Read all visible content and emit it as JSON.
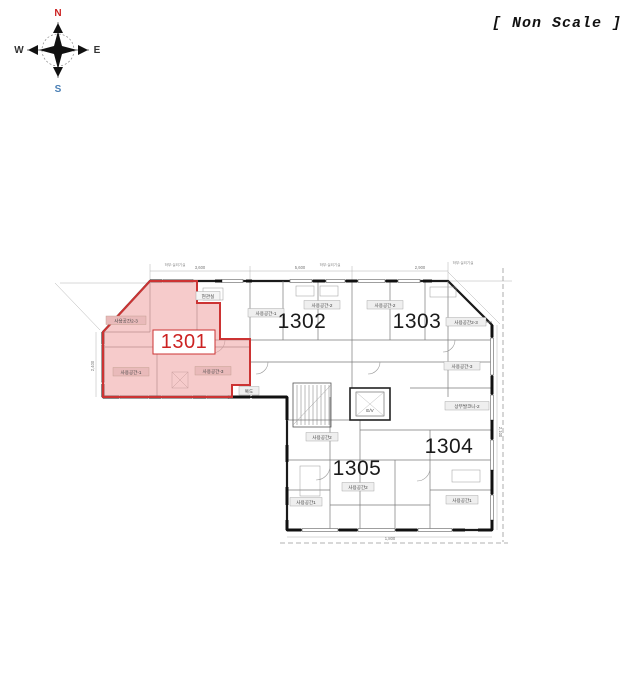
{
  "scale_note": "[ Non Scale ]",
  "compass": {
    "n": "N",
    "e": "E",
    "s": "S",
    "w": "W",
    "colors": {
      "n": "#cc2222",
      "s": "#4a7fb5",
      "ew": "#333333"
    }
  },
  "plan": {
    "highlight": {
      "fill": "#efa0a0",
      "border": "#cc3333"
    },
    "units": [
      {
        "label": "1301",
        "highlighted": true
      },
      {
        "label": "1302",
        "highlighted": false
      },
      {
        "label": "1303",
        "highlighted": false
      },
      {
        "label": "1304",
        "highlighted": false
      },
      {
        "label": "1305",
        "highlighted": false
      }
    ],
    "rooms": [
      {
        "label": "사용공간2-3"
      },
      {
        "label": "사용공간-1"
      },
      {
        "label": "사용공간-3"
      },
      {
        "label": "현관실"
      },
      {
        "label": "사용공간-1"
      },
      {
        "label": "사용공간-2"
      },
      {
        "label": "사용공간-2"
      },
      {
        "label": "사용공간2-3"
      },
      {
        "label": "사용공간-3"
      },
      {
        "label": "상부발코니-2"
      },
      {
        "label": "사용공간1"
      },
      {
        "label": "사용공간2"
      },
      {
        "label": "사용공간1"
      },
      {
        "label": "사용공간2"
      },
      {
        "label": "복도"
      }
    ],
    "dims": [
      "3,600",
      "5,600",
      "2,900",
      "2,400",
      "2,100",
      "1,800"
    ],
    "notes": [
      "하부:실외기실",
      "하부:실외기실",
      "하부:실외기실"
    ],
    "core": {
      "elevator": "E/V"
    }
  }
}
